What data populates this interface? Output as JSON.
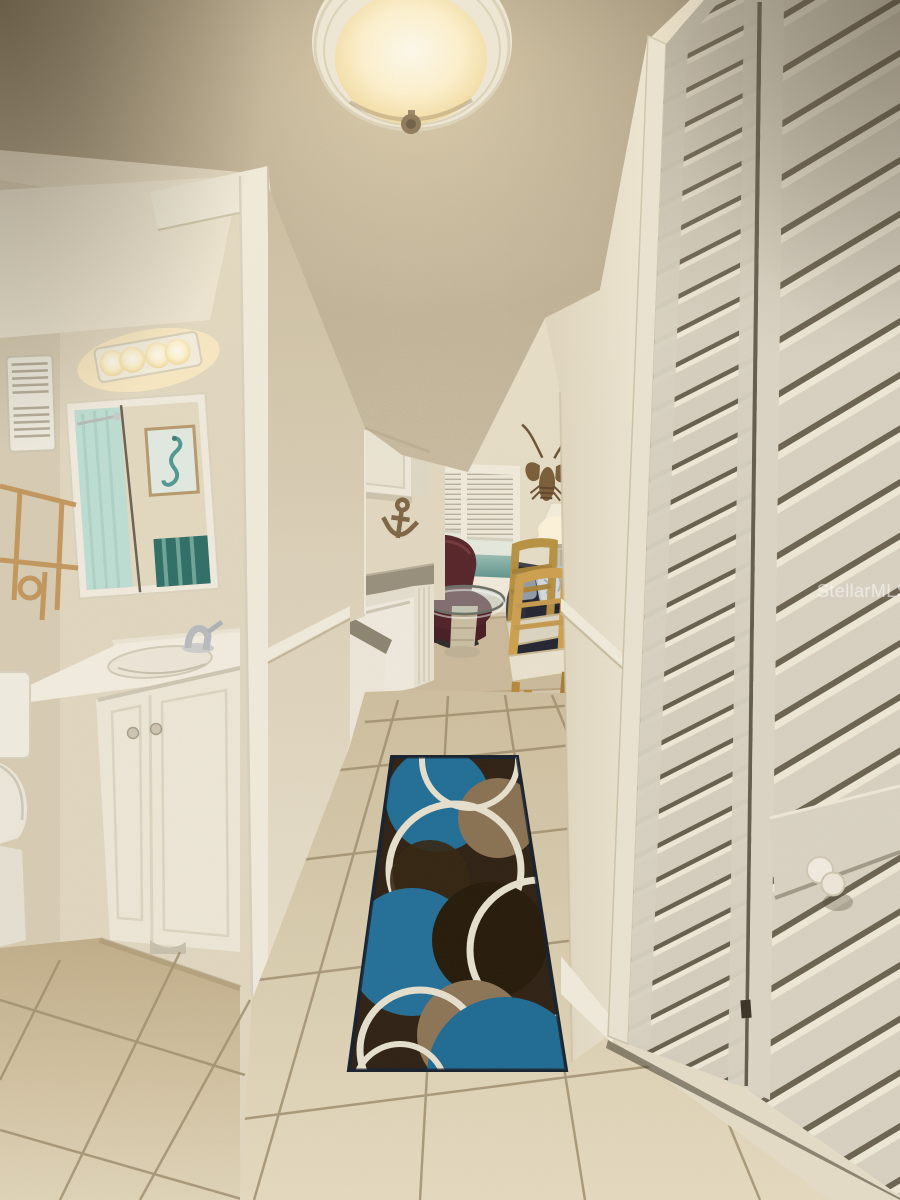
{
  "meta": {
    "type": "real-estate-listing-photo",
    "width_px": 900,
    "height_px": 1200
  },
  "watermark": {
    "text": "StellarMLS",
    "opacity": 0.55,
    "color": "#fafaf8"
  },
  "scene": {
    "description": "Condo interior hallway: bathroom with white vanity and mirror on the left, cream louvered closet doors on the right, beige tile floor with a teal/brown circle-pattern runner rug, leading past a small kitchen to a living room with an ocean-view window.",
    "objects": [
      "ceiling-dome-light",
      "popcorn-ceiling",
      "bathroom-doorway",
      "wall-heater",
      "vanity-light-bar",
      "medicine-cabinet-mirror",
      "shower-curtain-reflection",
      "seahorse-art-reflection",
      "towel-reflection",
      "rattan-shelf",
      "toilet",
      "vanity-cabinet",
      "sink",
      "faucet",
      "thermostat",
      "light-switch",
      "kitchen-upper-cabinet",
      "anchor-wall-decor",
      "kitchen-counter",
      "dishwasher",
      "half-wall",
      "window-with-blinds",
      "ocean-view",
      "ceiling-fan-blade",
      "lobster-wall-decor",
      "table-lamp",
      "burgundy-recliner",
      "glass-coffee-table",
      "dark-sofa",
      "throw-pillows",
      "oak-dining-chairs",
      "living-area-rug",
      "runner-rug",
      "tile-floor",
      "chair-rail",
      "baseboard",
      "louvered-closet-doors",
      "closet-door-knob",
      "watermark"
    ]
  },
  "palette": {
    "ceiling": "#b7a88e",
    "ceilingShadow": "#8f8067",
    "wall": "#e7dec9",
    "wallShadow": "#cfc1a4",
    "trim": "#f2edde",
    "tile": "#ddd1b4",
    "tileShadow": "#c7b493",
    "grout": "#a1906f",
    "louverDoor": "#d7d0c1",
    "louverGap": "#675f4e",
    "rugBrown": "#2d1f12",
    "rugTeal": "#1f6e97",
    "rugTan": "#8a7152",
    "rugCream": "#e8e2d0",
    "seaView": "#6fa39c",
    "reclinerBurgundy": "#4f2026",
    "sofaDark": "#212330",
    "chairOak": "#cfa14f",
    "lampShade": "#f6efdd",
    "curtainTeal": "#bfe0d6",
    "towelTeal": "#2e6e66",
    "bulbGlow": "#ffe9b8"
  }
}
